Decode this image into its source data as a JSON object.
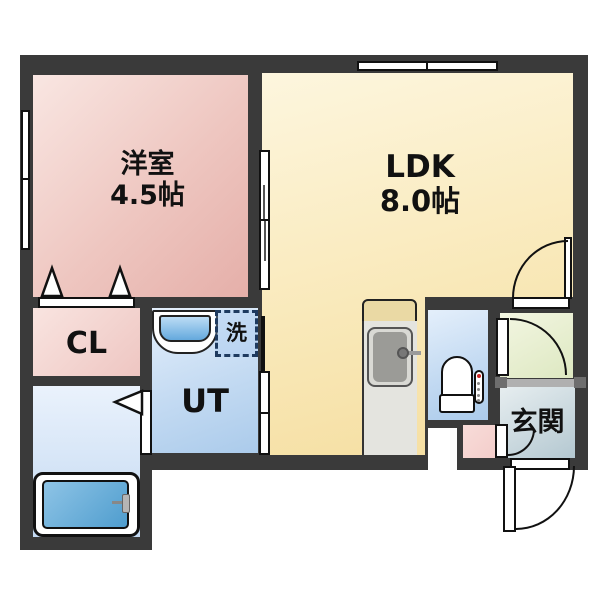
{
  "rooms": {
    "western": {
      "label": "洋室",
      "size": "4.5帖"
    },
    "ldk": {
      "label": "LDK",
      "size": "8.0帖"
    },
    "closet": {
      "label": "CL"
    },
    "utility": {
      "label": "UT"
    },
    "laundry": {
      "label": "洗"
    },
    "entrance": {
      "label": "玄関"
    }
  },
  "colors": {
    "wall": "#3a3a3a",
    "western_room": "#edc3be",
    "ldk": "#f8e7b4",
    "wet_rooms": "#c3daf2",
    "hallway": "#e4ecce",
    "entrance_hall": "#c4d4dc",
    "laundry_dash_border": "#1e3a5f",
    "text": "#111111"
  }
}
